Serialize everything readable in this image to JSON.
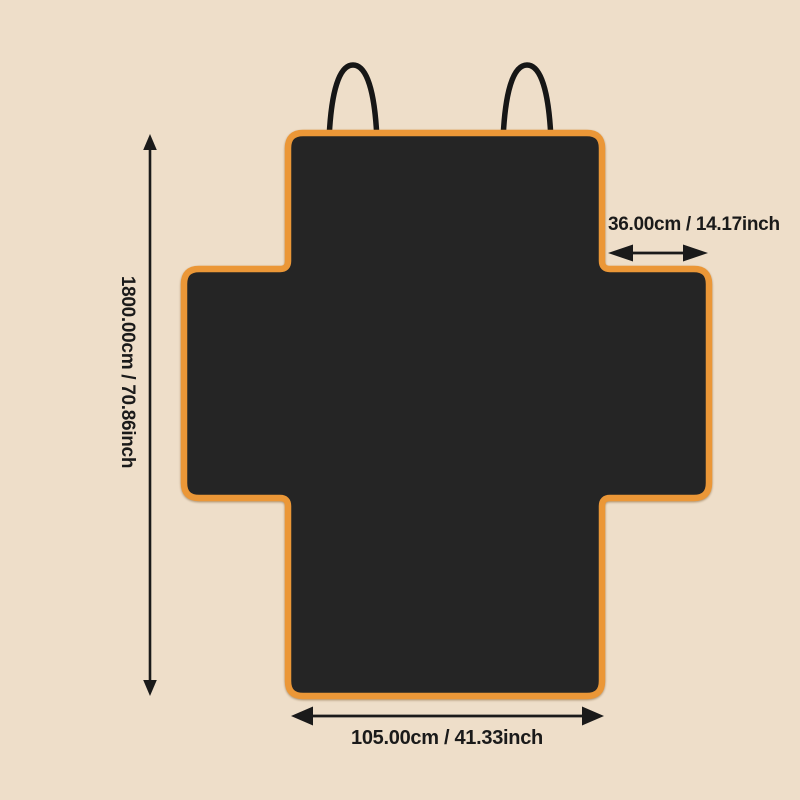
{
  "page": {
    "background_color": "#EEDEC9"
  },
  "cover": {
    "fill_color": "#252525",
    "border_color": "#EB9737",
    "handle_color": "#161616"
  },
  "dimensions": {
    "line_color": "#1A1A1A",
    "height_label": "1800.00cm / 70.86inch",
    "width_label": "105.00cm / 41.33inch",
    "flap_width_label": "36.00cm / 14.17inch"
  }
}
